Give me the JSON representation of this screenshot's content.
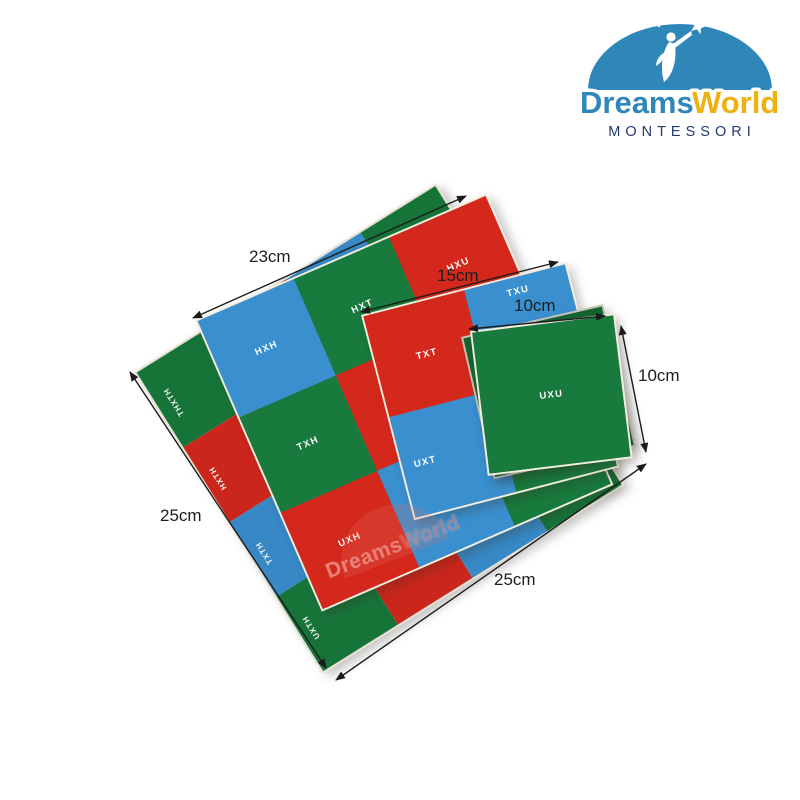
{
  "logo": {
    "brand_primary": "Dreams",
    "brand_secondary": "World",
    "subtitle": "MONTESSORI"
  },
  "watermark": {
    "primary": "Dreams",
    "secondary": "World"
  },
  "colors": {
    "cell_red": "#d5281d",
    "cell_green": "#187a3c",
    "cell_blue": "#3a8fce",
    "board_edge": "#f2eddf",
    "arrow": "#1b1b1b",
    "logo_blue": "#2f86b8",
    "logo_yellow": "#efb011",
    "logo_navy": "#223a70",
    "background": "#ffffff"
  },
  "dimensions": {
    "board_23_top": "23cm",
    "board_15_top": "15cm",
    "board_10_top": "10cm",
    "board_10_right": "10cm",
    "board_25_left": "25cm",
    "board_25_bottom": "25cm"
  },
  "boards": [
    {
      "name": "checker-board-25cm",
      "cells": [
        {
          "label": "THXTH"
        },
        {
          "label": ""
        },
        {
          "label": ""
        },
        {
          "label": "THXU"
        },
        {
          "label": "HXTH"
        },
        {
          "label": ""
        },
        {
          "label": ""
        },
        {
          "label": ""
        },
        {
          "label": "TXTH"
        },
        {
          "label": ""
        },
        {
          "label": ""
        },
        {
          "label": ""
        },
        {
          "label": "UXTH"
        },
        {
          "label": ""
        },
        {
          "label": ""
        },
        {
          "label": ""
        }
      ]
    },
    {
      "name": "checker-board-23cm",
      "cells": [
        {
          "label": "HXH"
        },
        {
          "label": "HXT"
        },
        {
          "label": "HXU"
        },
        {
          "label": "TXH"
        },
        {
          "label": ""
        },
        {
          "label": ""
        },
        {
          "label": "UXH"
        },
        {
          "label": ""
        },
        {
          "label": ""
        }
      ]
    },
    {
      "name": "checker-board-15cm",
      "cells": [
        {
          "label": "TXT"
        },
        {
          "label": "TXU"
        },
        {
          "label": "UXT"
        },
        {
          "label": ""
        }
      ]
    },
    {
      "name": "checker-board-10cm-under",
      "cells": [
        {
          "label": ""
        }
      ]
    },
    {
      "name": "checker-board-10cm",
      "cells": [
        {
          "label": "UXU"
        }
      ]
    }
  ]
}
